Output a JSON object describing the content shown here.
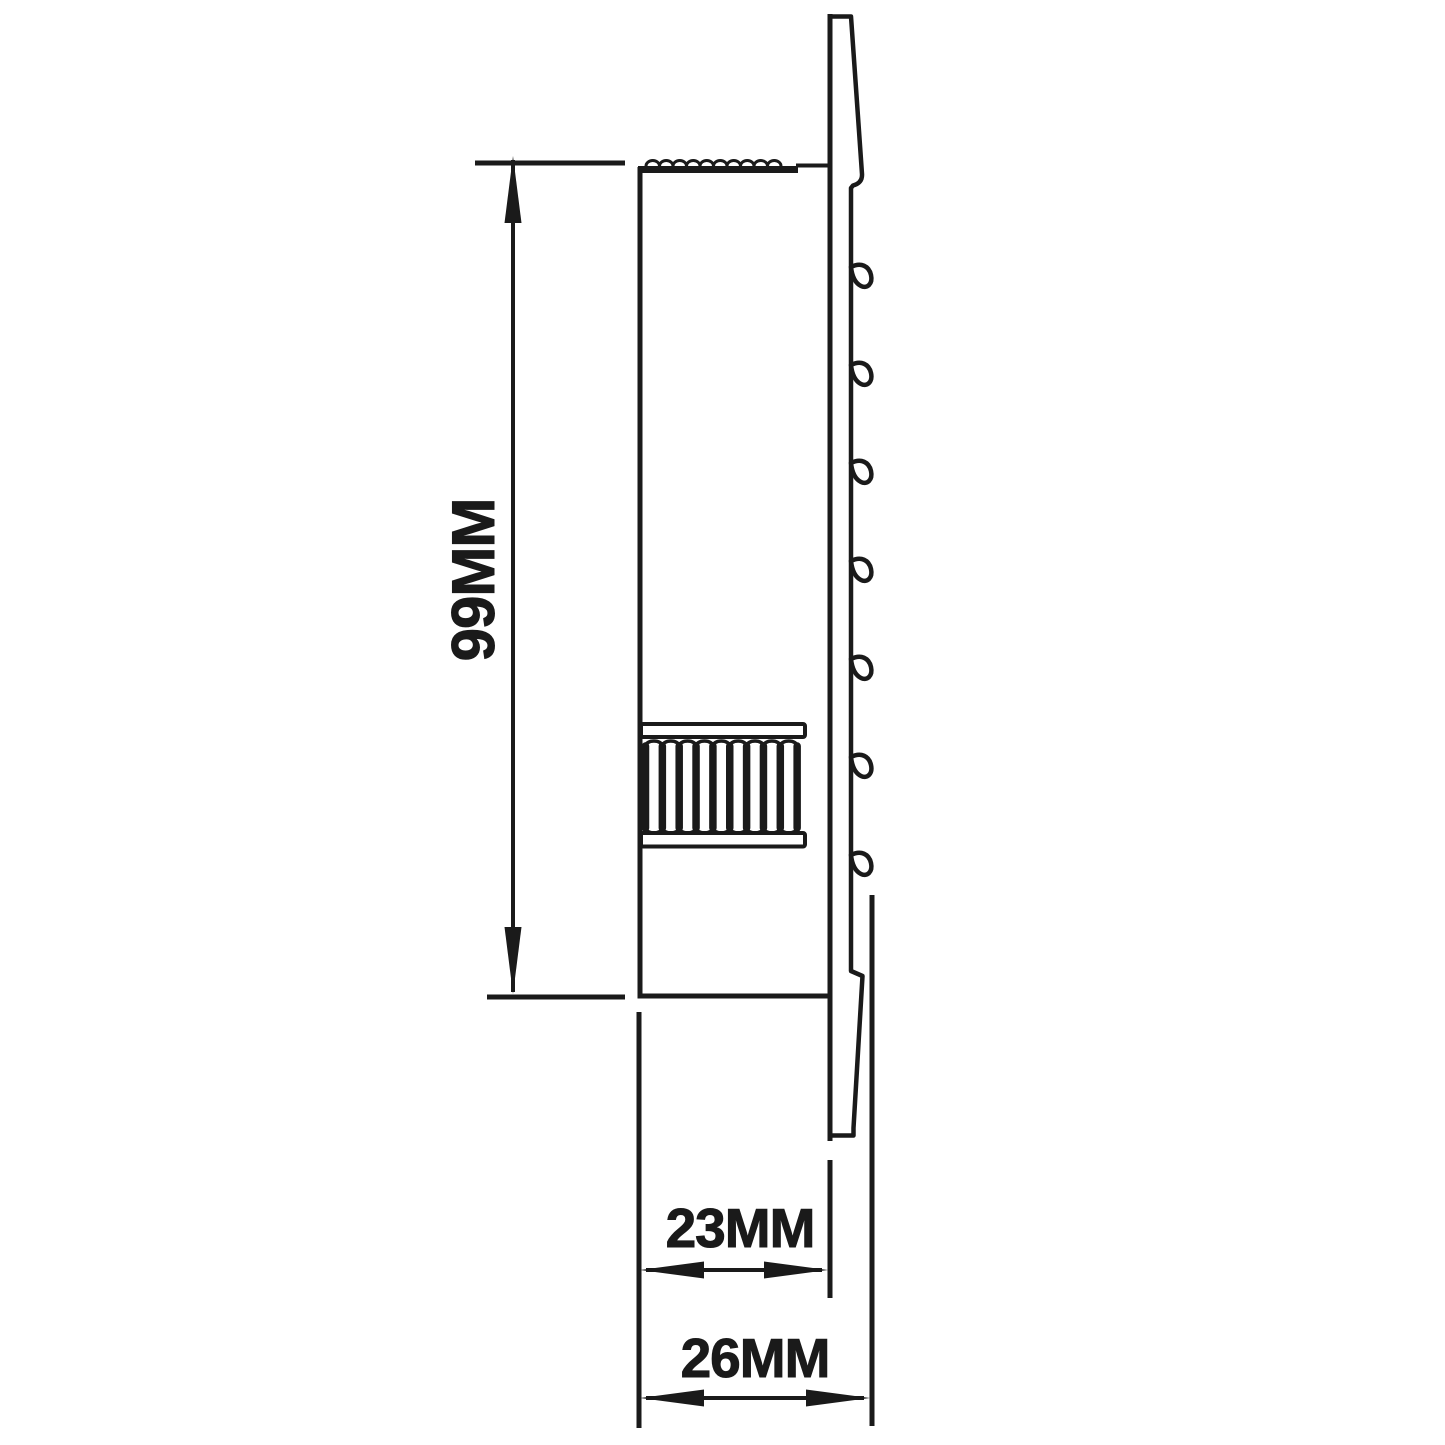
{
  "drawing": {
    "type": "technical-dimension-diagram",
    "background": "#ffffff",
    "line_color": "#1a1a1a",
    "dimensions": {
      "height_label": "99MM",
      "inner_depth_label": "23MM",
      "overall_depth_label": "26MM"
    },
    "features": {
      "barb_count": 7,
      "rib_count": 10,
      "knurl_bump_count": 10
    }
  }
}
